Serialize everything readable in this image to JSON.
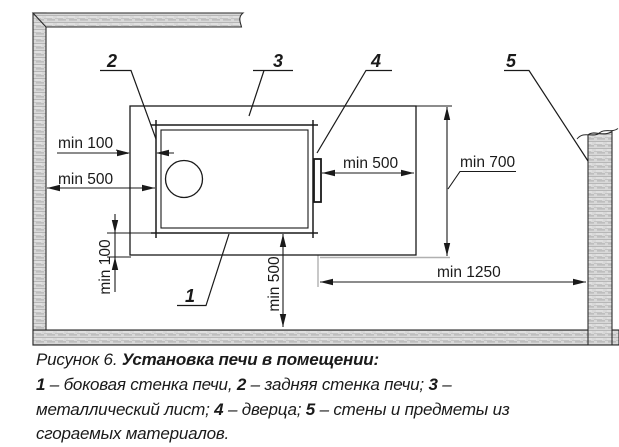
{
  "diagram": {
    "dims": {
      "back_gap": "min 100",
      "back_clearance": "min 500",
      "front_clearance": "min 500",
      "sheet_depth": "min 700",
      "front_wall_clearance": "min 1250",
      "side_gap": "min 100",
      "side_clearance": "min 500"
    },
    "callouts": {
      "c1": "1",
      "c2": "2",
      "c3": "3",
      "c4": "4",
      "c5": "5"
    },
    "colors": {
      "line": "#1a1a1a",
      "wall_fill": "#d8d8d8",
      "extension_gray": "#b0b0b0"
    }
  },
  "caption": {
    "figure_label": "Рисунок 6.",
    "title": "Установка печи в помещении:",
    "items": [
      {
        "num": "1",
        "desc": "– боковая стенка печи,"
      },
      {
        "num": "2",
        "desc": "– задняя стенка печи;"
      },
      {
        "num": "3",
        "desc": "– металлический лист;"
      },
      {
        "num": "4",
        "desc": "– дверца;"
      },
      {
        "num": "5",
        "desc": "– стены и предметы из сгораемых материалов."
      }
    ]
  }
}
